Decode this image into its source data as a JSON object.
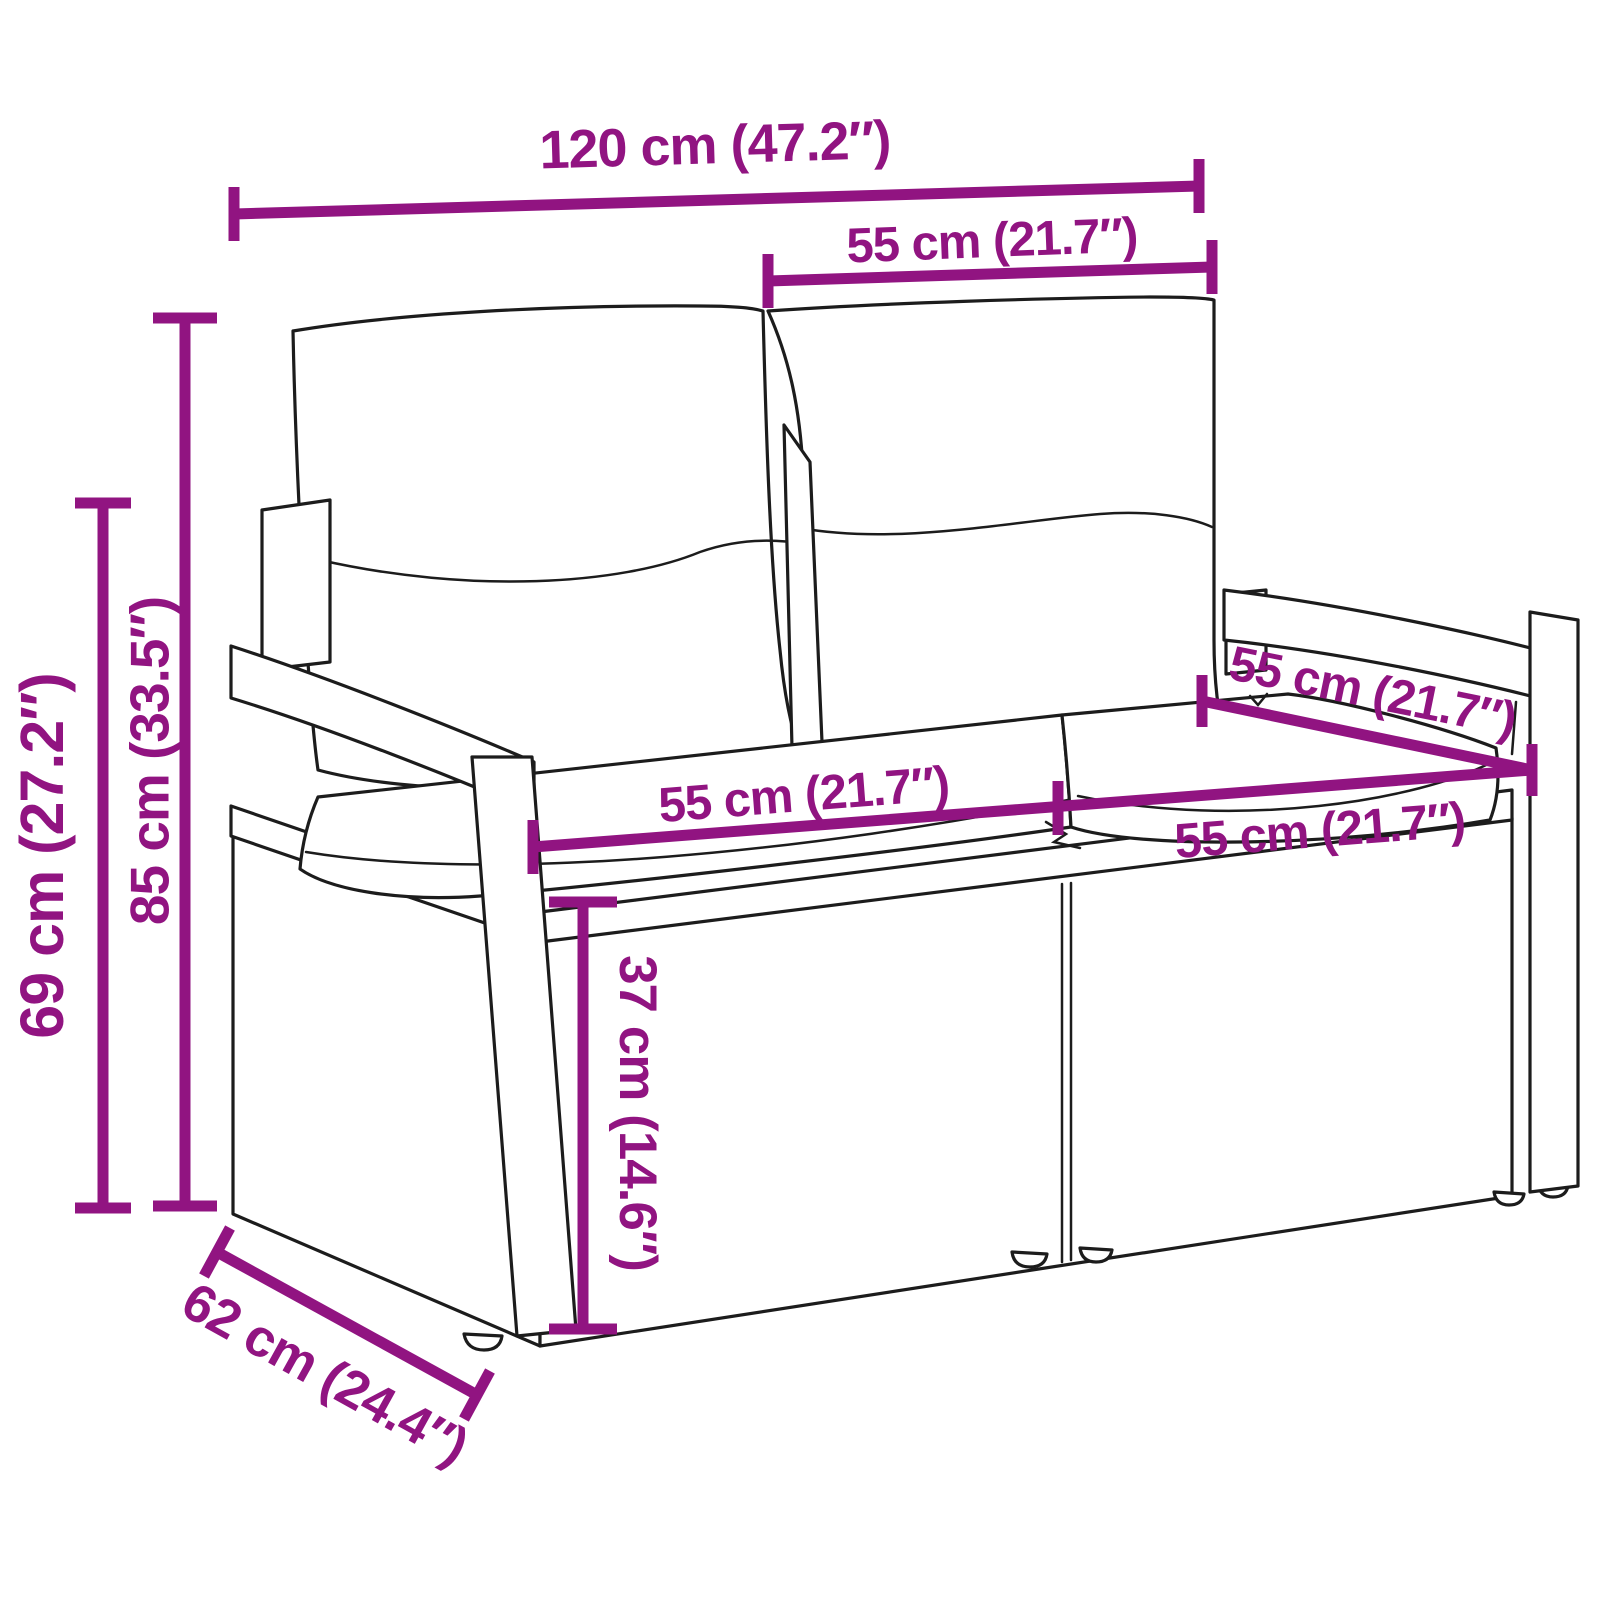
{
  "colors": {
    "dimension_accent": "#911481",
    "line_art": "#1c1c1c",
    "background": "#ffffff"
  },
  "dims": {
    "overall_width": "120 cm (47.2″)",
    "back_cushion_width": "55 cm (21.7″)",
    "total_height": "85 cm (33.5″)",
    "armrest_height": "69 cm (27.2″)",
    "seat_depth": "55 cm (21.7″)",
    "seat_width_left": "55 cm (21.7″)",
    "seat_width_right": "55 cm (21.7″)",
    "seat_height": "37 cm (14.6″)",
    "overall_depth": "62 cm (24.4″)"
  }
}
